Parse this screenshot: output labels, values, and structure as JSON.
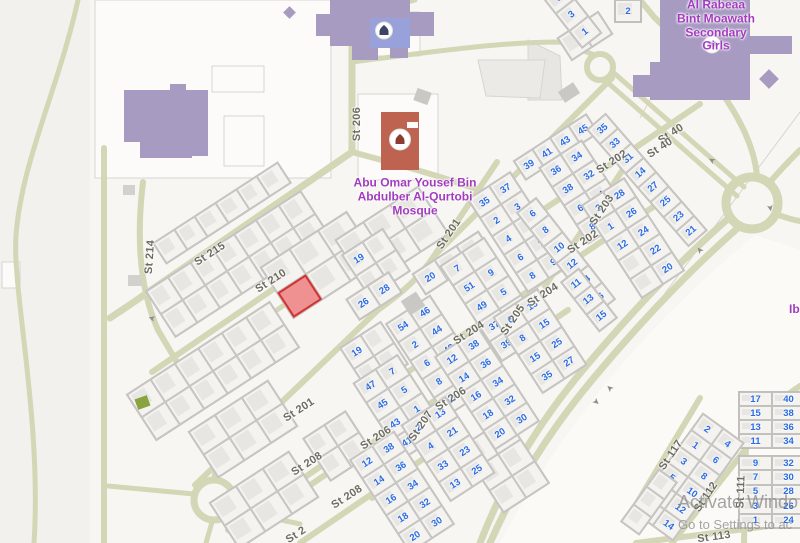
{
  "watermark": {
    "line1": "Activate Windo",
    "line2": "Go to Settings to ac"
  },
  "poi": {
    "mosque_label": "Abu Omar Yousef Bin\nAbdulber Al-Qurtobi\nMosque",
    "mosque_x": 415,
    "mosque_y": 197,
    "school_label": "Al Rabeaa Bint Moawath\nSecondary Girls",
    "school_x": 716,
    "school_y": 26,
    "ibn_label": "Ibn",
    "ibn_x": 789,
    "ibn_y": 310
  },
  "colors": {
    "land": "#f7f6f2",
    "land_left": "#f2f1ed",
    "land_se": "#fbfaf7",
    "road": "#d3d7b6",
    "parcel_line": "#d6d5d2",
    "parcel_fill": "#fcfbf9",
    "number_blue": "#2b6be4",
    "street_gray": "#6c6c60",
    "poi_purple": "#a23cbe",
    "school_purple": "#a89bc2",
    "mosque_blue": "#98a1d9",
    "mosque_red": "#bf6351",
    "selected_red": "#f09191",
    "selected_border": "#cf3333",
    "green_bld": "#8aa33f",
    "gray_bld": "#c9c8c5"
  },
  "streets": [
    {
      "t": "St 206",
      "x": 357,
      "y": 124,
      "a": -90
    },
    {
      "t": "St 201",
      "x": 449,
      "y": 234,
      "a": -56
    },
    {
      "t": "St 202",
      "x": 612,
      "y": 162,
      "a": -33
    },
    {
      "t": "St 40",
      "x": 671,
      "y": 134,
      "a": -33
    },
    {
      "t": "St 40",
      "x": 660,
      "y": 148,
      "a": -33
    },
    {
      "t": "St 203",
      "x": 602,
      "y": 210,
      "a": -56
    },
    {
      "t": "St 202",
      "x": 583,
      "y": 242,
      "a": -33
    },
    {
      "t": "St 214",
      "x": 150,
      "y": 257,
      "a": -86
    },
    {
      "t": "St 215",
      "x": 210,
      "y": 254,
      "a": -33
    },
    {
      "t": "St 210",
      "x": 271,
      "y": 281,
      "a": -33
    },
    {
      "t": "St 204",
      "x": 543,
      "y": 295,
      "a": -33
    },
    {
      "t": "St 205",
      "x": 513,
      "y": 320,
      "a": -56
    },
    {
      "t": "St 204",
      "x": 469,
      "y": 333,
      "a": -33
    },
    {
      "t": "St 206",
      "x": 451,
      "y": 399,
      "a": -33
    },
    {
      "t": "St 207",
      "x": 421,
      "y": 426,
      "a": -56
    },
    {
      "t": "St 206",
      "x": 376,
      "y": 438,
      "a": -33
    },
    {
      "t": "St 201",
      "x": 299,
      "y": 410,
      "a": -33
    },
    {
      "t": "St 208",
      "x": 307,
      "y": 464,
      "a": -33
    },
    {
      "t": "St 208",
      "x": 347,
      "y": 497,
      "a": -33
    },
    {
      "t": "St 2",
      "x": 296,
      "y": 535,
      "a": -33
    },
    {
      "t": "St 117",
      "x": 671,
      "y": 455,
      "a": -56
    },
    {
      "t": "St 112",
      "x": 706,
      "y": 497,
      "a": -56
    },
    {
      "t": "St 111",
      "x": 741,
      "y": 492,
      "a": -88
    },
    {
      "t": "St 113",
      "x": 714,
      "y": 537,
      "a": -8
    }
  ],
  "blocks": [
    {
      "x": 238,
      "y": 264,
      "w": 186,
      "h": 56,
      "a": -33,
      "rows": 2,
      "cols": 7
    },
    {
      "x": 222,
      "y": 213,
      "w": 150,
      "h": 26,
      "a": -33,
      "rows": 1,
      "cols": 6
    },
    {
      "x": 213,
      "y": 371,
      "w": 172,
      "h": 56,
      "a": -33,
      "rows": 2,
      "cols": 6
    },
    {
      "x": 320,
      "y": 265,
      "w": 104,
      "h": 62,
      "a": -33,
      "rows": 2,
      "cols": 3,
      "red": [
        1,
        0
      ]
    },
    {
      "x": 392,
      "y": 237,
      "w": 100,
      "h": 58,
      "a": -33,
      "rows": 2,
      "cols": 3
    },
    {
      "x": 376,
      "y": 263,
      "w": 50,
      "h": 52,
      "a": -33,
      "rows": 2,
      "cols": 2,
      "nums": [
        "19",
        "",
        "",
        ""
      ]
    },
    {
      "x": 374,
      "y": 356,
      "w": 50,
      "h": 52,
      "a": -33,
      "rows": 2,
      "cols": 2,
      "nums": [
        "19",
        "",
        "",
        ""
      ]
    },
    {
      "x": 374,
      "y": 296,
      "w": 52,
      "h": 26,
      "a": -33,
      "rows": 1,
      "cols": 2,
      "nums": [
        "26",
        "28"
      ]
    },
    {
      "x": 243,
      "y": 429,
      "w": 96,
      "h": 56,
      "a": -33,
      "rows": 2,
      "cols": 3
    },
    {
      "x": 264,
      "y": 500,
      "w": 96,
      "h": 56,
      "a": -33,
      "rows": 2,
      "cols": 3
    },
    {
      "x": 338,
      "y": 446,
      "w": 52,
      "h": 52,
      "a": -33,
      "rows": 2,
      "cols": 2
    },
    {
      "x": 585,
      "y": 36,
      "w": 50,
      "h": 28,
      "a": -33,
      "rows": 1,
      "cols": 2
    },
    {
      "x": 505,
      "y": 465,
      "w": 56,
      "h": 80,
      "a": -33,
      "rows": 3,
      "cols": 2
    },
    {
      "x": 556,
      "y": 147,
      "w": 88,
      "h": 24,
      "a": -33,
      "rows": 1,
      "cols": 4,
      "nums": [
        "39",
        "41",
        "43",
        "45"
      ]
    },
    {
      "x": 647,
      "y": 180,
      "w": 26,
      "h": 156,
      "a": -41,
      "rows": 8,
      "cols": 1,
      "nums": [
        "35",
        "33",
        "31",
        "14",
        "27",
        "25",
        "23",
        "21"
      ]
    },
    {
      "x": 585,
      "y": 192,
      "w": 52,
      "h": 92,
      "a": -33,
      "rows": 4,
      "cols": 2,
      "nums": [
        "36",
        "34",
        "38",
        "32",
        "6",
        "4",
        "8",
        "2"
      ]
    },
    {
      "x": 633,
      "y": 238,
      "w": 52,
      "h": 112,
      "a": -33,
      "rows": 5,
      "cols": 2,
      "nums": [
        "3",
        "28",
        "1",
        "26",
        "12",
        "24",
        "",
        "22",
        "",
        "20"
      ]
    },
    {
      "x": 519,
      "y": 232,
      "w": 52,
      "h": 112,
      "a": -33,
      "rows": 5,
      "cols": 2,
      "nums": [
        "35",
        "37",
        "2",
        "3",
        "4",
        "5",
        "6",
        "7",
        "8",
        "9"
      ]
    },
    {
      "x": 566,
      "y": 256,
      "w": 26,
      "h": 130,
      "a": -38,
      "rows": 6,
      "cols": 1,
      "nums": [
        "6",
        "8",
        "10",
        "12",
        "14",
        "16"
      ]
    },
    {
      "x": 589,
      "y": 300,
      "w": 24,
      "h": 64,
      "a": -38,
      "rows": 3,
      "cols": 1,
      "nums": [
        "11",
        "13",
        "15"
      ]
    },
    {
      "x": 452,
      "y": 263,
      "w": 80,
      "h": 26,
      "a": -33,
      "rows": 1,
      "cols": 3,
      "nums": [
        "20",
        "18",
        "16"
      ]
    },
    {
      "x": 438,
      "y": 356,
      "w": 54,
      "h": 112,
      "a": -33,
      "rows": 5,
      "cols": 2,
      "nums": [
        "54",
        "46",
        "2",
        "44",
        "6",
        "42",
        "8",
        "40",
        "10",
        "38"
      ]
    },
    {
      "x": 487,
      "y": 389,
      "w": 54,
      "h": 112,
      "a": -33,
      "rows": 5,
      "cols": 2,
      "nums": [
        "12",
        "38",
        "14",
        "36",
        "16",
        "34",
        "18",
        "32",
        "20",
        "30"
      ]
    },
    {
      "x": 493,
      "y": 299,
      "w": 54,
      "h": 115,
      "a": -33,
      "rows": 5,
      "cols": 2,
      "nums": [
        "7",
        "",
        "51",
        "9",
        "49",
        "5",
        "37",
        "7",
        "39",
        ""
      ]
    },
    {
      "x": 540,
      "y": 341,
      "w": 54,
      "h": 92,
      "a": -33,
      "rows": 4,
      "cols": 2,
      "nums": [
        "6",
        "13",
        "8",
        "15",
        "15",
        "25",
        "35",
        "27"
      ]
    },
    {
      "x": 400,
      "y": 407,
      "w": 54,
      "h": 92,
      "a": -33,
      "rows": 4,
      "cols": 2,
      "nums": [
        "47",
        "7",
        "45",
        "5",
        "43",
        "1",
        "41",
        "3"
      ]
    },
    {
      "x": 402,
      "y": 492,
      "w": 54,
      "h": 112,
      "a": -33,
      "rows": 5,
      "cols": 2,
      "nums": [
        "12",
        "38",
        "14",
        "36",
        "16",
        "34",
        "18",
        "32",
        "20",
        "30"
      ]
    },
    {
      "x": 448,
      "y": 449,
      "w": 54,
      "h": 92,
      "a": -33,
      "rows": 4,
      "cols": 2,
      "nums": [
        "2",
        "13",
        "4",
        "21",
        "33",
        "23",
        "13",
        "25"
      ]
    },
    {
      "x": 572,
      "y": 15,
      "w": 26,
      "h": 66,
      "a": -38,
      "rows": 3,
      "cols": 1,
      "nums": [
        "5",
        "3",
        "1"
      ]
    },
    {
      "x": 628,
      "y": 11,
      "w": 28,
      "h": 24,
      "a": 0,
      "rows": 1,
      "cols": 1,
      "nums": [
        "2"
      ]
    },
    {
      "x": 772,
      "y": 420,
      "w": 68,
      "h": 58,
      "a": 0,
      "rows": 4,
      "cols": 2,
      "nums": [
        "17",
        "40",
        "15",
        "38",
        "13",
        "36",
        "11",
        "34"
      ]
    },
    {
      "x": 772,
      "y": 492,
      "w": 68,
      "h": 74,
      "a": 0,
      "rows": 5,
      "cols": 2,
      "nums": [
        "9",
        "32",
        "7",
        "30",
        "5",
        "28",
        "3",
        "26",
        "1",
        "24"
      ]
    },
    {
      "x": 688,
      "y": 477,
      "w": 52,
      "h": 122,
      "a": 36,
      "rows": 6,
      "cols": 2,
      "nums": [
        "2",
        "4",
        "1",
        "6",
        "3",
        "8",
        "5",
        "10",
        "7",
        "12",
        "9",
        "14"
      ]
    },
    {
      "x": 649,
      "y": 502,
      "w": 24,
      "h": 66,
      "a": 36,
      "rows": 3,
      "cols": 1
    }
  ],
  "buildings": [
    {
      "x": 330,
      "y": 0,
      "w": 80,
      "h": 46,
      "c": "#a89bc2",
      "r": 0,
      "name": "school-building"
    },
    {
      "x": 316,
      "y": 14,
      "w": 18,
      "h": 22,
      "c": "#a89bc2",
      "r": 0,
      "name": "school-building"
    },
    {
      "x": 408,
      "y": 12,
      "w": 26,
      "h": 24,
      "c": "#a89bc2",
      "r": 0,
      "name": "school-building"
    },
    {
      "x": 352,
      "y": 40,
      "w": 26,
      "h": 20,
      "c": "#a89bc2",
      "r": 0,
      "name": "school-building"
    },
    {
      "x": 390,
      "y": 42,
      "w": 18,
      "h": 16,
      "c": "#a89bc2",
      "r": 0,
      "name": "school-building"
    },
    {
      "x": 285,
      "y": 8,
      "w": 9,
      "h": 9,
      "c": "#a89bc2",
      "r": 45,
      "name": "school-building"
    },
    {
      "x": 124,
      "y": 90,
      "w": 84,
      "h": 52,
      "c": "#a89bc2",
      "r": 0,
      "name": "school-building"
    },
    {
      "x": 140,
      "y": 134,
      "w": 52,
      "h": 24,
      "c": "#a89bc2",
      "r": 0,
      "name": "school-building"
    },
    {
      "x": 178,
      "y": 120,
      "w": 30,
      "h": 36,
      "c": "#a89bc2",
      "r": 0,
      "name": "school-building"
    },
    {
      "x": 170,
      "y": 84,
      "w": 16,
      "h": 10,
      "c": "#a89bc2",
      "r": 0,
      "name": "school-building"
    },
    {
      "x": 660,
      "y": 0,
      "w": 90,
      "h": 100,
      "c": "#a89bc2",
      "r": 0,
      "name": "school-building"
    },
    {
      "x": 748,
      "y": 36,
      "w": 44,
      "h": 18,
      "c": "#a89bc2",
      "r": 0,
      "name": "school-building"
    },
    {
      "x": 650,
      "y": 62,
      "w": 20,
      "h": 38,
      "c": "#a89bc2",
      "r": 0,
      "name": "school-building"
    },
    {
      "x": 762,
      "y": 72,
      "w": 14,
      "h": 14,
      "c": "#a89bc2",
      "r": 45,
      "name": "school-building"
    },
    {
      "x": 633,
      "y": 75,
      "w": 27,
      "h": 22,
      "c": "#a89bc2",
      "r": 0,
      "name": "school-building"
    },
    {
      "x": 370,
      "y": 18,
      "w": 40,
      "h": 30,
      "c": "#98a1d9",
      "r": 0,
      "name": "mosque-building-blue"
    },
    {
      "x": 381,
      "y": 112,
      "w": 38,
      "h": 58,
      "c": "#bf6351",
      "r": 0,
      "name": "mosque-building-red"
    },
    {
      "x": 407,
      "y": 122,
      "w": 11,
      "h": 6,
      "c": "#fcfbf9",
      "r": 0,
      "name": "mosque-building-notch"
    },
    {
      "x": 560,
      "y": 86,
      "w": 18,
      "h": 13,
      "c": "#c9c8c5",
      "r": -33,
      "name": "gray-building"
    },
    {
      "x": 404,
      "y": 295,
      "w": 18,
      "h": 17,
      "c": "#c9c8c5",
      "r": -33,
      "name": "gray-building"
    },
    {
      "x": 415,
      "y": 90,
      "w": 15,
      "h": 13,
      "c": "#c9c8c5",
      "r": 20,
      "name": "gray-building"
    },
    {
      "x": 123,
      "y": 185,
      "w": 12,
      "h": 10,
      "c": "#d2d1ce",
      "r": 0,
      "name": "gray-building"
    },
    {
      "x": 128,
      "y": 275,
      "w": 14,
      "h": 11,
      "c": "#d2d1ce",
      "r": 0,
      "name": "gray-building"
    },
    {
      "x": 136,
      "y": 397,
      "w": 13,
      "h": 11,
      "c": "#8aa33f",
      "r": -20,
      "name": "green-building"
    }
  ],
  "roads": [
    {
      "d": "M352,0 L352,152",
      "w": 7
    },
    {
      "d": "M352,152 L128,306 L110,318",
      "w": 7
    },
    {
      "d": "M104,148 L104,543",
      "w": 6
    },
    {
      "d": "M78,0 C58,90 22,160 16,235 C12,290 42,420 34,543",
      "w": 5
    },
    {
      "d": "M352,30 C375,12 392,6 415,0",
      "w": 5
    },
    {
      "d": "M352,62 C430,52 500,42 560,42 L592,54",
      "w": 5
    },
    {
      "d": "M607,82 L737,196",
      "w": 5
    },
    {
      "d": "M614,73 L744,187",
      "w": 5
    },
    {
      "d": "M770,182 C782,168 792,158 800,150",
      "w": 6
    },
    {
      "d": "M757,176 C752,120 700,60 655,18 L640,0",
      "w": 6
    },
    {
      "d": "M776,214 C786,218 794,220 800,221",
      "w": 6
    },
    {
      "d": "M740,226 C692,268 642,320 592,380 C562,416 522,470 490,543",
      "w": 7
    },
    {
      "d": "M730,217 C682,259 632,311 582,371 C552,407 512,461 480,543",
      "w": 7
    },
    {
      "d": "M497,162 L434,256 C420,277 402,293 378,310 L195,485",
      "w": 6
    },
    {
      "d": "M434,256 L612,78",
      "w": 6
    },
    {
      "d": "M352,152 C420,170 470,185 540,212",
      "w": 6
    },
    {
      "d": "M540,212 L700,104",
      "w": 6
    },
    {
      "d": "M632,156 L545,286",
      "w": 6
    },
    {
      "d": "M378,392 L656,205",
      "w": 6
    },
    {
      "d": "M560,248 L448,415",
      "w": 6
    },
    {
      "d": "M300,492 L568,310",
      "w": 6
    },
    {
      "d": "M468,352 L372,498",
      "w": 6
    },
    {
      "d": "M228,530 L340,453",
      "w": 6
    },
    {
      "d": "M300,543 L448,442",
      "w": 6
    },
    {
      "d": "M152,372 L392,208",
      "w": 6
    },
    {
      "d": "M143,182 C136,240 140,290 158,330 L198,398",
      "w": 6
    },
    {
      "d": "M136,406 L362,252",
      "w": 5
    },
    {
      "d": "M214,478 L220,440",
      "w": 5
    },
    {
      "d": "M194,494 L108,486",
      "w": 5
    },
    {
      "d": "M212,522 L206,543",
      "w": 5
    },
    {
      "d": "M234,510 L300,524",
      "w": 5
    },
    {
      "d": "M700,398 L628,518",
      "w": 6
    },
    {
      "d": "M748,446 L672,543",
      "w": 6
    },
    {
      "d": "M746,440 L744,543",
      "w": 6
    },
    {
      "d": "M636,543 L800,522",
      "w": 6
    },
    {
      "d": "M800,386 C770,406 754,424 746,444",
      "w": 6
    }
  ],
  "circles": [
    {
      "x": 600,
      "y": 67,
      "r": 13,
      "w": 6
    },
    {
      "x": 752,
      "y": 203,
      "r": 26,
      "w": 9
    },
    {
      "x": 214,
      "y": 500,
      "r": 20,
      "w": 7
    }
  ],
  "parcels": [
    {
      "type": "rect",
      "x": 95,
      "y": 0,
      "w": 236,
      "h": 178
    },
    {
      "type": "rect",
      "x": 212,
      "y": 66,
      "w": 52,
      "h": 26
    },
    {
      "type": "rect",
      "x": 224,
      "y": 116,
      "w": 40,
      "h": 50
    },
    {
      "type": "rect",
      "x": 358,
      "y": 94,
      "w": 80,
      "h": 86
    },
    {
      "type": "rect",
      "x": 362,
      "y": 12,
      "w": 58,
      "h": 44
    },
    {
      "type": "rect",
      "x": 2,
      "y": 262,
      "w": 18,
      "h": 26
    },
    {
      "type": "line",
      "x1": 640,
      "y1": 118,
      "x2": 704,
      "y2": 0
    },
    {
      "type": "line",
      "x1": 660,
      "y1": 300,
      "x2": 800,
      "y2": 112
    },
    {
      "type": "poly",
      "pts": "528,40 560,56 562,100 528,100",
      "fill": "#e7e6e2"
    },
    {
      "type": "poly",
      "pts": "478,60 545,60 540,98 486,96",
      "fill": "#eceae6"
    }
  ],
  "arrows": [
    {
      "x": 152,
      "y": 318,
      "a": 195
    },
    {
      "x": 712,
      "y": 160,
      "a": 210
    },
    {
      "x": 770,
      "y": 208,
      "a": 80
    },
    {
      "x": 700,
      "y": 250,
      "a": 230
    },
    {
      "x": 610,
      "y": 388,
      "a": 222
    },
    {
      "x": 596,
      "y": 402,
      "a": 42
    }
  ],
  "icons": [
    {
      "name": "mosque-icon",
      "x": 400,
      "y": 142,
      "r": 11,
      "glyph": "#8d3b30"
    },
    {
      "name": "mosque-icon",
      "x": 384,
      "y": 33,
      "r": 9,
      "glyph": "#3d4566"
    },
    {
      "name": "school-book-icon",
      "x": 712,
      "y": 47,
      "r": 9,
      "glyph": "#8b5fb0"
    }
  ]
}
